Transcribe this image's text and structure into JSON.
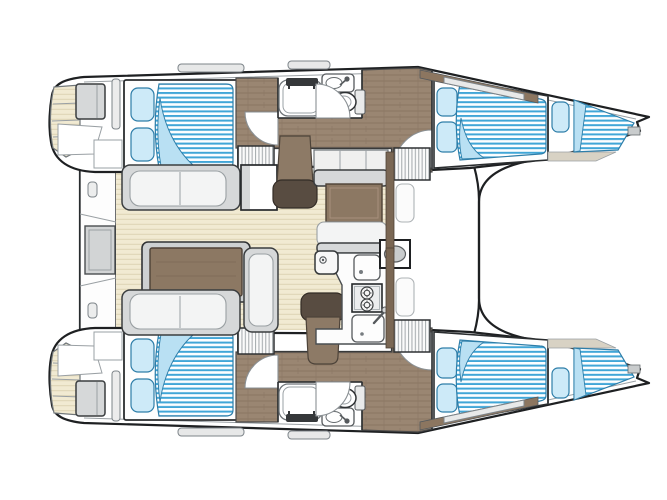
{
  "meta": {
    "title": "Catamaran interior layout — top-down floor plan, bow to the right",
    "visible_text": "",
    "view": "overhead deck plan"
  },
  "colors": {
    "background": "#ffffff",
    "outline": "#1e2022",
    "secondary_line": "#9aa0a4",
    "teak": "#f1ead2",
    "teak_stripe": "#ddd3b4",
    "wood": "#9a8672",
    "wood_grain": "#8a7663",
    "wood_dark": "#7a6754",
    "wood_table": "#8c7863",
    "chair_wood": "#8d7a66",
    "chair_back": "#584c41",
    "gray_furniture": "#d6d8d9",
    "cushion": "#f3f4f4",
    "mattress_stripe": "#41a6d7",
    "mattress_base": "#fdfeff",
    "mattress_fold": "#b9e0f3",
    "pillow": "#cdeaf8",
    "pillow_outline": "#2e7ea9",
    "fixture_outline": "#55595c",
    "hatch_line": "#9ba1a5",
    "side_deck": "#8c7660",
    "forepeak_floor": "#d8d2c4"
  },
  "boat": {
    "orientation": "bow-right",
    "hulls": [
      {
        "id": "port-hull",
        "position": "top",
        "rooms": [
          "stern-platform-with-steps",
          "aft-double-cabin",
          "head-with-shower-sink-toilet",
          "companionway-corridor",
          "forward-double-cabin",
          "forepeak-berth"
        ]
      },
      {
        "id": "starboard-hull",
        "position": "bottom",
        "rooms": [
          "stern-platform-with-steps",
          "aft-double-cabin",
          "head-with-shower-sink-toilet",
          "companionway-corridor",
          "forward-double-cabin",
          "forepeak-berth"
        ]
      }
    ],
    "bridgedeck": {
      "areas": [
        "aft-platform-with-gate",
        "cockpit-with-benches-and-table",
        "salon-dinette-table",
        "galley",
        "forward-lounge"
      ],
      "cockpit": {
        "benches": 3,
        "tables": 2,
        "chairs": 2
      },
      "galley": {
        "stove_burners": 2,
        "sinks": 2,
        "faucets": 1
      }
    },
    "totals": {
      "double_berths": 4,
      "forepeak_berths": 2,
      "heads": 2,
      "showers": 2,
      "companionway_steps": 4
    }
  }
}
